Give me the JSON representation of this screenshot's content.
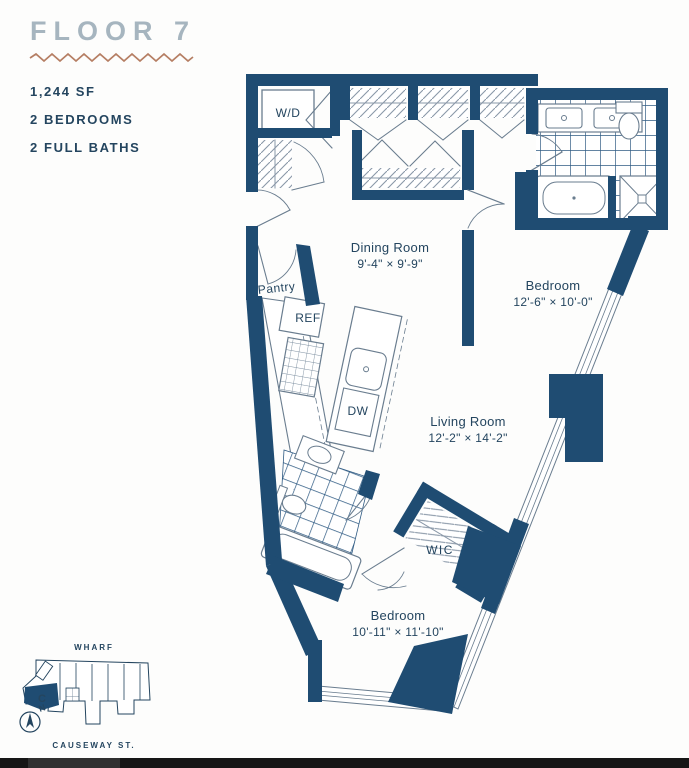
{
  "header": {
    "title": "FLOOR 7"
  },
  "unit": {
    "area": "1,244 SF",
    "bedrooms": "2 BEDROOMS",
    "baths": "2 FULL BATHS"
  },
  "floorplan": {
    "rooms": [
      {
        "name": "Dining Room",
        "dims": "9'-4\" × 9'-9\""
      },
      {
        "name": "Bedroom",
        "dims": "12'-6\" × 10'-0\""
      },
      {
        "name": "Living Room",
        "dims": "12'-2\" × 14'-2\""
      },
      {
        "name": "Bedroom",
        "dims": "10'-11\" × 11'-10\""
      }
    ],
    "labels": {
      "wd": "W/D",
      "pantry": "Pantry",
      "ref": "REF",
      "dw": "DW",
      "wic": "WIC"
    }
  },
  "sitemap": {
    "street_top": "WHARF",
    "street_bottom": "CAUSEWAY ST.",
    "unit_letter": "C",
    "compass": "N"
  },
  "colors": {
    "wall": "#1f4c72",
    "accent_zigzag": "#b57e63",
    "title": "#a6b5bf",
    "text": "#24455f"
  }
}
